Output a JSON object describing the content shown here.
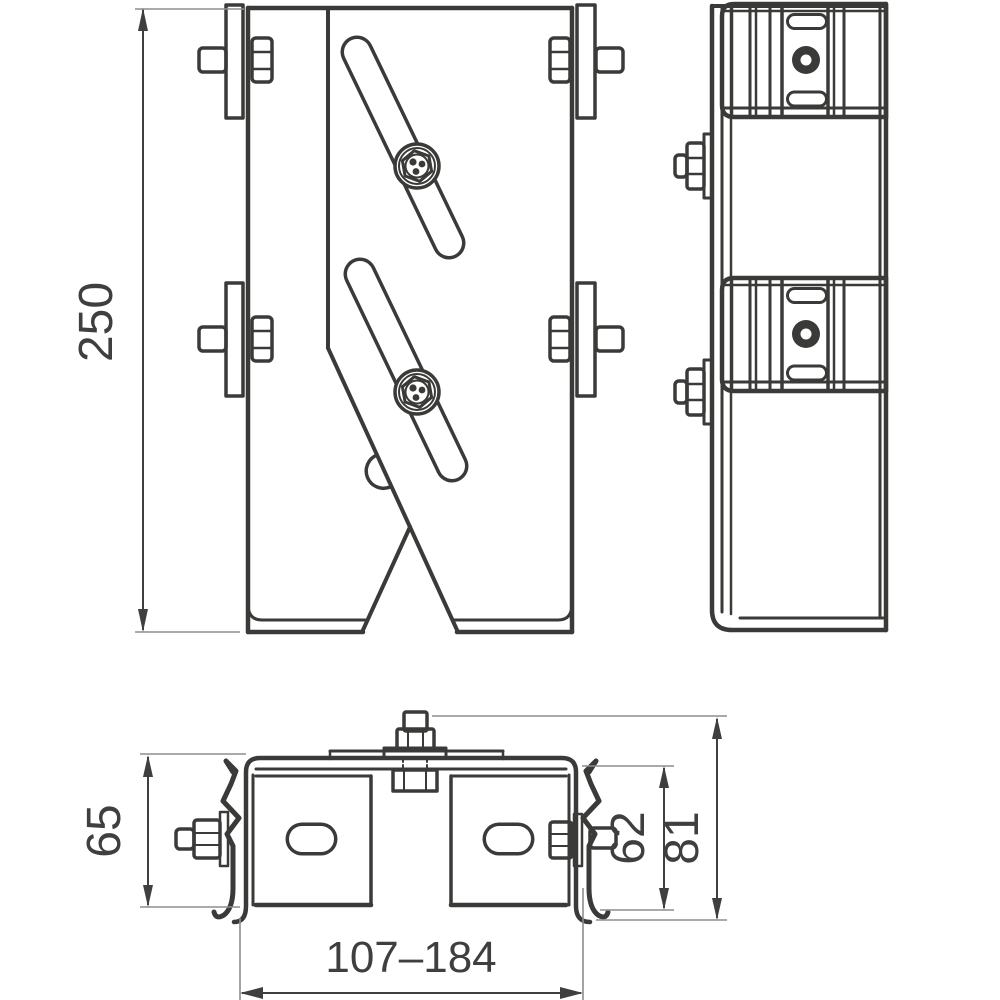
{
  "colors": {
    "line": "#3a3a38",
    "dimension": "#3f3f3e",
    "extension": "#8e8e8c",
    "background": "#ffffff"
  },
  "dimensions": {
    "overall_height": {
      "label": "250"
    },
    "channel_height": {
      "label": "65"
    },
    "clip_height": {
      "label": "62"
    },
    "total_depth": {
      "label": "81"
    },
    "width_range": {
      "label": "107–184"
    }
  }
}
